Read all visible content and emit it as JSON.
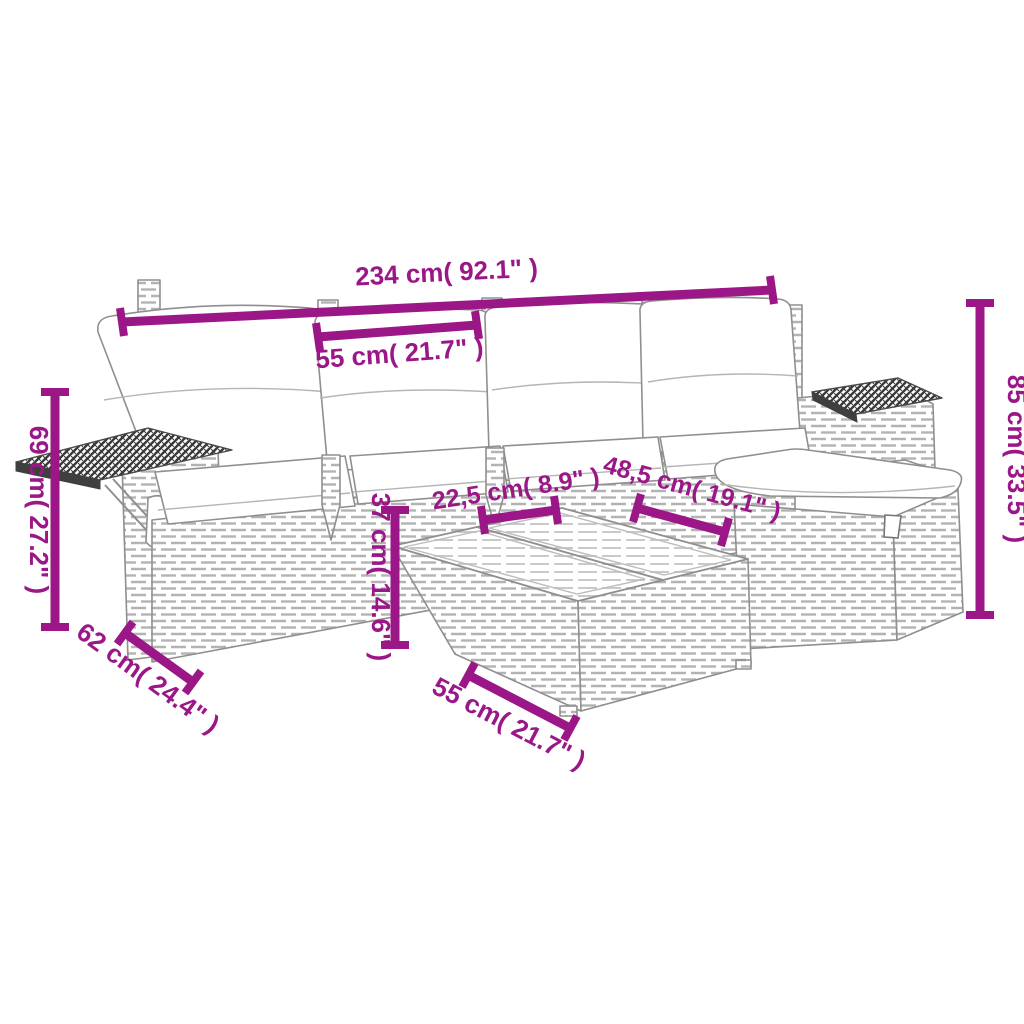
{
  "page": {
    "type": "product-dimension-diagram",
    "subject": "rattan garden lounge furniture set with cushions, ottoman and side table",
    "background": "#ffffff"
  },
  "style": {
    "dimension_color": "#9B1787",
    "artwork_line_color": "#8f8f8f",
    "cushion_color": "#ffffff"
  },
  "dims": {
    "overall_width": "234 cm( 92.1\" )",
    "seat_width": "55 cm( 21.7\" )",
    "back_height": "69 cm( 27.2\" )",
    "total_height": "85 cm( 33.5\" )",
    "seat_height": "37 cm( 14.6\" )",
    "inner_width": "22,5 cm( 8.9\" )",
    "table_width": "48,5 cm( 19.1\" )",
    "sofa_depth": "62 cm( 24.4\" )",
    "table_depth": "55 cm( 21.7\" )"
  }
}
